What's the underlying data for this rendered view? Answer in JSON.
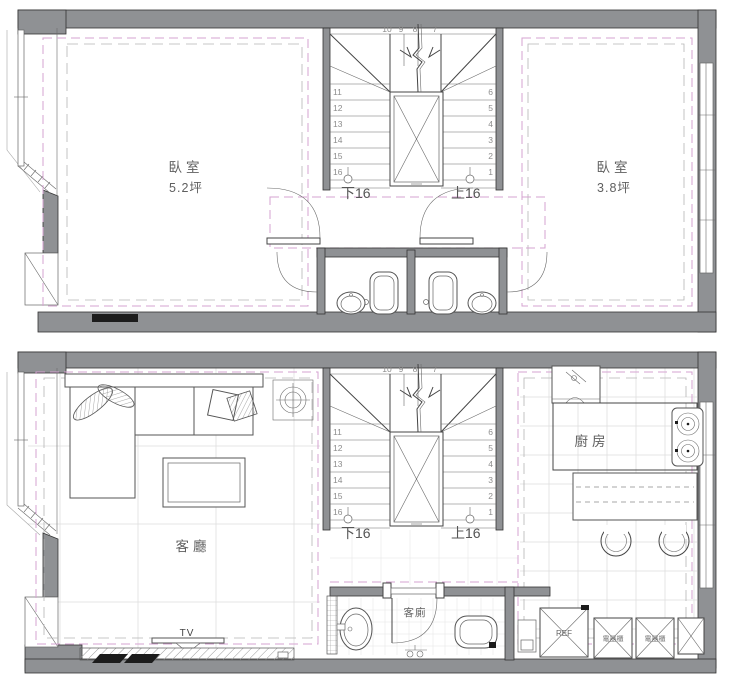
{
  "colors": {
    "wall_fill": "#8f9194",
    "line": "#444444",
    "ceiling_dash_pink": "#d5a3d1",
    "structure_dash_gray": "#b5b5b5",
    "background": "#ffffff"
  },
  "upper_plan": {
    "bedroom_left": {
      "label": "臥室",
      "area": "5.2坪"
    },
    "bedroom_right": {
      "label": "臥室",
      "area": "3.8坪"
    }
  },
  "lower_plan": {
    "living_room_label": "客廳",
    "kitchen_label": "廚房",
    "guest_toilet_label": "客廁",
    "tv_label": "TV",
    "fridge_label": "REF",
    "appliance_cabinet_label": "電器櫃"
  },
  "staircase": {
    "top_numbers": [
      "10",
      "9",
      "8",
      "7"
    ],
    "left_numbers": [
      "11",
      "12",
      "13",
      "14",
      "15",
      "16"
    ],
    "right_numbers": [
      "6",
      "5",
      "4",
      "3",
      "2",
      "1"
    ],
    "down_label": "下16",
    "up_label": "上16"
  }
}
